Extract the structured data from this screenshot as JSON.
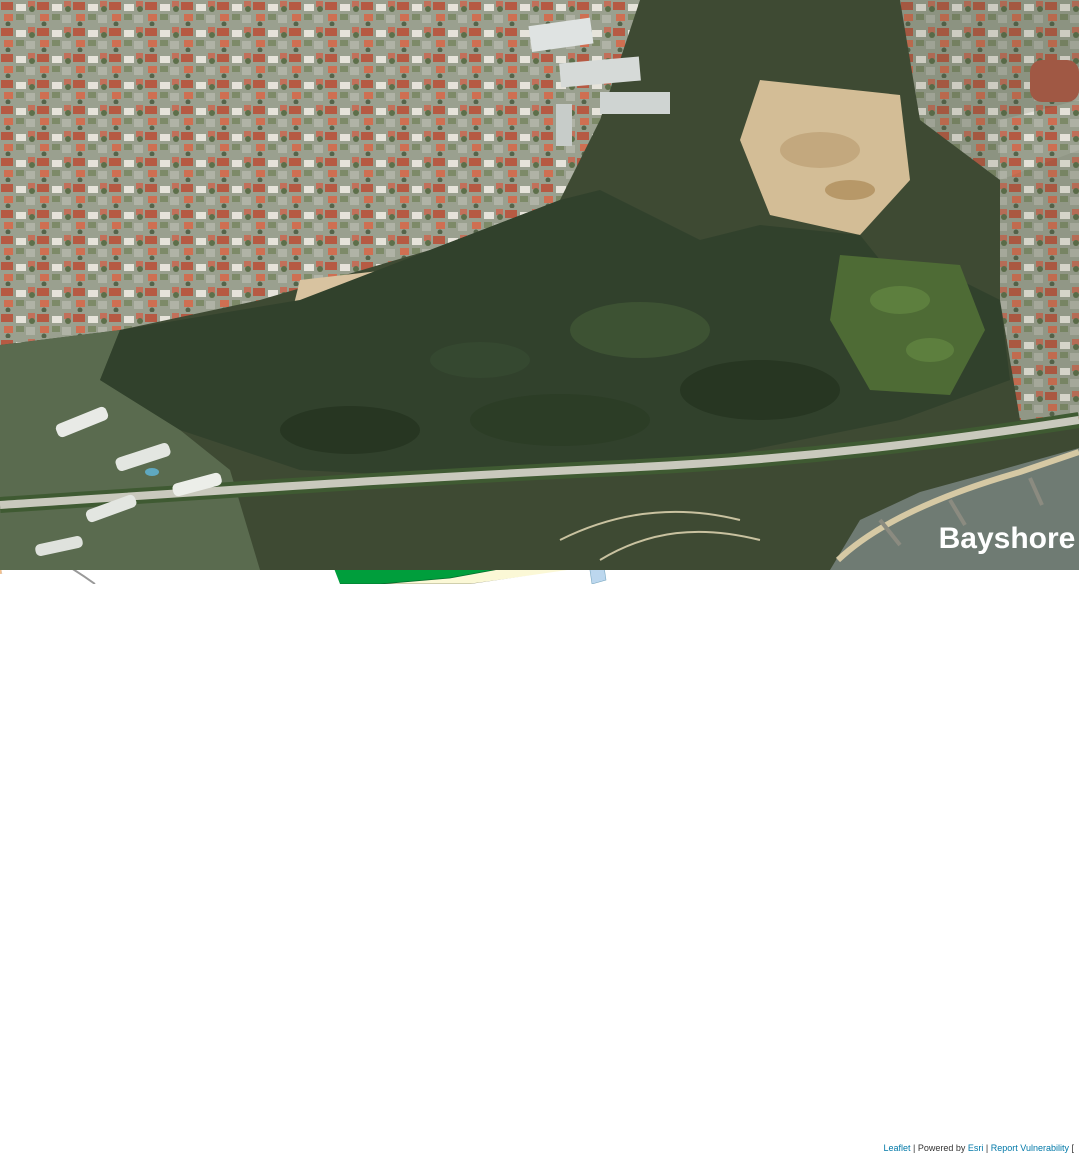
{
  "satellite": {
    "label": "Bayshore"
  },
  "map": {
    "colors": {
      "parcel_residential": "#F3BF8C",
      "parcel_dense": "#F0B87F",
      "road": "#FFFFFF",
      "civic_institution": "#F3F0CB",
      "utility_olive": "#A4AD13",
      "utility_olive_light": "#B4BA2E",
      "park_green": "#009E3C",
      "park_dark_green": "#537B1E",
      "open_space_light": "#ABD39C",
      "beach_sand": "#FBF8D6",
      "waterway_blue": "#BCD7EE",
      "commercial_blue": "#29A9E0",
      "worship_red": "#C50000",
      "utility_gray": "#9C9C9C",
      "mrt_pink": "#F4897C",
      "overhead_link_teal": "#79D9B1"
    },
    "labels": [
      {
        "n": "road-south",
        "t": "SOUTH",
        "x": 508,
        "y": 598,
        "r": 82,
        "s": 15,
        "ls": 2
      },
      {
        "n": "road-avenue",
        "t": "AVENUE",
        "x": 532,
        "y": 664,
        "r": 72,
        "s": 15,
        "ls": 2
      },
      {
        "n": "road-avenue-3",
        "t": "3",
        "x": 551,
        "y": 723,
        "r": 55,
        "s": 15
      },
      {
        "n": "road-bedok-south-road",
        "t": "ROAD",
        "x": 714,
        "y": 629,
        "r": 68,
        "s": 16,
        "ls": 2
      },
      {
        "n": "road-upper",
        "t": "UPPER",
        "x": 825,
        "y": 667,
        "r": -13,
        "s": 16,
        "ls": 3
      },
      {
        "n": "road-east-upper",
        "t": "EAST",
        "x": 936,
        "y": 630,
        "r": -16,
        "s": 16,
        "ls": 3
      },
      {
        "n": "road-coast-upper",
        "t": "COAST",
        "x": 1050,
        "y": 597,
        "r": -18,
        "s": 16,
        "ls": 3
      },
      {
        "n": "road-east-ecr",
        "t": "EAST",
        "x": 193,
        "y": 850,
        "r": -8,
        "s": 16,
        "ls": 3
      },
      {
        "n": "road-coast-ecr",
        "t": "COAST",
        "x": 420,
        "y": 803,
        "r": -13,
        "s": 16,
        "ls": 3
      },
      {
        "n": "road-road-ecr",
        "t": "ROAD",
        "x": 649,
        "y": 713,
        "r": -23,
        "s": 16,
        "ls": 3
      },
      {
        "n": "road-bayshore-vertical",
        "t": "BAYSHORE",
        "x": 254,
        "y": 911,
        "r": 78,
        "s": 12,
        "ls": 1
      },
      {
        "n": "road-east-ecp",
        "t": "EAST",
        "x": 213,
        "y": 1108,
        "r": -9,
        "s": 17,
        "ls": 4
      },
      {
        "n": "road-coast-ecp",
        "t": "COAST",
        "x": 898,
        "y": 1014,
        "r": -11,
        "s": 17,
        "ls": 4
      },
      {
        "n": "road-road-small-vertical",
        "t": "ROAD",
        "x": 274,
        "y": 1010,
        "r": 80,
        "s": 9,
        "f": "#444",
        "w": 400
      },
      {
        "n": "road-kew-cres",
        "t": "KEW CRES",
        "x": 727,
        "y": 592,
        "r": -36,
        "s": 7,
        "f": "#333",
        "w": 400
      },
      {
        "n": "road-bayshore-road",
        "t": "BAYSHORE  ROAD",
        "x": 172,
        "y": 1012,
        "r": -9,
        "s": 10,
        "st": 1,
        "ls": 1,
        "f": "#fff"
      },
      {
        "n": "road-future-road",
        "t": "Future Road",
        "x": 704,
        "y": 842,
        "r": -14,
        "s": 14,
        "i": 1
      },
      {
        "n": "road-future-road-vertical",
        "t": "Future Road",
        "x": 822,
        "y": 931,
        "r": 88,
        "s": 12
      },
      {
        "n": "zone-1-4-a",
        "t": "1.4",
        "x": 325,
        "y": 757,
        "s": 13
      },
      {
        "n": "zone-1-4-b",
        "t": "1.4",
        "x": 463,
        "y": 668,
        "s": 13
      },
      {
        "n": "zone-1-4-c",
        "t": "1.4",
        "x": 207,
        "y": 876,
        "s": 13
      },
      {
        "n": "zone-1-4-d",
        "t": "1.4",
        "x": 126,
        "y": 898,
        "s": 13
      },
      {
        "n": "zone-1-4-e",
        "t": "1.4",
        "x": 284,
        "y": 868,
        "s": 13
      },
      {
        "n": "zone-1-4-f",
        "t": "1.4",
        "x": 372,
        "y": 844,
        "s": 13
      },
      {
        "n": "zone-1-4-g",
        "t": "1.4",
        "x": 433,
        "y": 824,
        "s": 13
      },
      {
        "n": "zone-2-9",
        "t": "2.9",
        "x": 656,
        "y": 631,
        "s": 14
      },
      {
        "n": "zone-2-8-blue",
        "t": "2.8",
        "x": 885,
        "y": 717,
        "s": 14
      },
      {
        "n": "zone-2-8-mid",
        "t": "2.8",
        "x": 628,
        "y": 828,
        "s": 14
      },
      {
        "n": "zone-2-8-right",
        "t": "2.8",
        "x": 913,
        "y": 877,
        "s": 14
      },
      {
        "n": "zone-3-0",
        "t": "3.0",
        "x": 172,
        "y": 964,
        "s": 14
      },
      {
        "n": "zone-3-5-southwest",
        "t": "3.5",
        "x": 200,
        "y": 1050,
        "s": 14
      },
      {
        "n": "zone-3-5-station",
        "t": "3.5",
        "x": 343,
        "y": 1005,
        "s": 14
      },
      {
        "n": "zone-e-west",
        "t": "E",
        "x": 128,
        "y": 799,
        "s": 13
      },
      {
        "n": "zone-e-civic",
        "t": "E",
        "x": 582,
        "y": 669,
        "s": 13
      },
      {
        "n": "zone-e-olive",
        "t": "E",
        "x": 676,
        "y": 764,
        "s": 13
      },
      {
        "n": "zone-w-west",
        "t": "W",
        "x": 196,
        "y": 891,
        "s": 9,
        "f": "#fff"
      },
      {
        "n": "zone-w-mid",
        "t": "W",
        "x": 410,
        "y": 831,
        "s": 9,
        "f": "#fff"
      },
      {
        "n": "zone-w-bedok",
        "t": "W",
        "x": 766,
        "y": 645,
        "s": 10,
        "f": "#fff"
      },
      {
        "n": "zone-h",
        "t": "H",
        "x": 297,
        "y": 866,
        "s": 8,
        "f": "#fff"
      },
      {
        "n": "zone-u-upper",
        "t": "U",
        "x": 1015,
        "y": 649,
        "s": 11
      },
      {
        "n": "zone-u-top",
        "t": "U",
        "x": 676,
        "y": 578,
        "s": 8,
        "f": "#fff"
      },
      {
        "n": "zone-u-small",
        "t": "U",
        "x": 770,
        "y": 622,
        "s": 7,
        "f": "#fff"
      },
      {
        "n": "future-housing-1",
        "t": "Future Housing",
        "x": 333,
        "y": 908,
        "s": 14
      },
      {
        "n": "future-housing-1-ratio",
        "t": "3.5",
        "x": 323,
        "y": 922,
        "s": 14
      },
      {
        "n": "future-housing-2",
        "t": "Future Housing",
        "x": 444,
        "y": 876,
        "s": 14
      },
      {
        "n": "future-housing-2-ratio",
        "t": "3.5",
        "x": 444,
        "y": 891,
        "s": 14
      },
      {
        "n": "future-housing-3",
        "t": "Future Housing",
        "x": 465,
        "y": 957,
        "s": 14
      },
      {
        "n": "future-housing-3-ratio",
        "t": "3.5",
        "x": 471,
        "y": 971,
        "s": 14
      },
      {
        "n": "future-housing-4",
        "t": "Future Housing",
        "x": 358,
        "y": 1024,
        "s": 14
      },
      {
        "n": "future-housing-5",
        "t": "Future Housing",
        "x": 560,
        "y": 847,
        "s": 14
      },
      {
        "n": "future-housing-6a",
        "t": "Future",
        "x": 605,
        "y": 907,
        "s": 14
      },
      {
        "n": "future-housing-6b",
        "t": "Housing",
        "x": 606,
        "y": 921,
        "s": 14
      },
      {
        "n": "future-housing-6-ratio",
        "t": "3.5",
        "x": 605,
        "y": 940,
        "s": 14
      },
      {
        "n": "future-housing-7",
        "t": "Future Housing",
        "x": 716,
        "y": 885,
        "s": 14
      },
      {
        "n": "future-housing-7-ratio",
        "t": "3.5",
        "x": 716,
        "y": 909,
        "s": 14
      },
      {
        "n": "future-housing-8",
        "t": "Future Housing",
        "x": 912,
        "y": 899,
        "s": 14
      },
      {
        "n": "future-school-1",
        "t": "Future",
        "x": 786,
        "y": 923,
        "s": 13
      },
      {
        "n": "future-school-2",
        "t": "School",
        "x": 786,
        "y": 937,
        "s": 13
      },
      {
        "n": "future-school-ratio",
        "t": "E",
        "x": 781,
        "y": 955,
        "s": 13
      },
      {
        "n": "future-park-1",
        "t": "Future",
        "x": 537,
        "y": 943,
        "s": 14,
        "f": "#fff"
      },
      {
        "n": "future-park-2",
        "t": "Park",
        "x": 537,
        "y": 958,
        "s": 14,
        "f": "#fff"
      },
      {
        "n": "future-healthcare-1",
        "t": "Future",
        "x": 589,
        "y": 976,
        "s": 8,
        "f": "#fff"
      },
      {
        "n": "future-healthcare-2",
        "t": "Healthcare",
        "x": 588,
        "y": 985,
        "s": 8,
        "f": "#fff"
      },
      {
        "n": "future-healthcare-3",
        "t": "Facility",
        "x": 588,
        "y": 994,
        "s": 8,
        "f": "#fff"
      },
      {
        "n": "future-worship-1",
        "t": "Future",
        "x": 711,
        "y": 974,
        "s": 8,
        "f": "#fff"
      },
      {
        "n": "future-worship-2",
        "t": "Place of",
        "x": 710,
        "y": 983,
        "s": 8,
        "f": "#fff"
      },
      {
        "n": "future-worship-3",
        "t": "Worship",
        "x": 710,
        "y": 992,
        "s": 8,
        "f": "#fff"
      },
      {
        "n": "future-overhead-link-1",
        "t": "Future Overhead Link",
        "x": 700,
        "y": 1066,
        "s": 13,
        "f": "#fff"
      },
      {
        "n": "future-overhead-link-2",
        "t": "to East Coast Park",
        "x": 699,
        "y": 1081,
        "s": 13,
        "f": "#fff"
      },
      {
        "n": "bayshore-mrt",
        "t": "Bayshore MRT",
        "x": 352,
        "y": 948,
        "r": -13,
        "s": 16,
        "f": "#fff"
      },
      {
        "n": "bedok-south-mrt",
        "t": "Bedok South MRT",
        "x": 821,
        "y": 719,
        "r": -54,
        "s": 13,
        "f": "#fff"
      },
      {
        "n": "future-commercial-1",
        "t": "Future Commercial +",
        "x": 893,
        "y": 741,
        "r": -13,
        "s": 15,
        "f": "#fff"
      },
      {
        "n": "future-commercial-2",
        "t": "Residential Development",
        "x": 886,
        "y": 759,
        "r": -13,
        "s": 15,
        "f": "#fff"
      },
      {
        "n": "scale-text",
        "t": "100m",
        "x": 984,
        "y": 1114,
        "s": 16,
        "w": 400,
        "f": "#222"
      }
    ],
    "attribution": {
      "leaflet": "Leaflet",
      "sep1": " | ",
      "powered": "Powered by ",
      "esri": "Esri",
      "sep2": " | ",
      "report": "Report Vulnerability",
      "tail": " ["
    }
  }
}
